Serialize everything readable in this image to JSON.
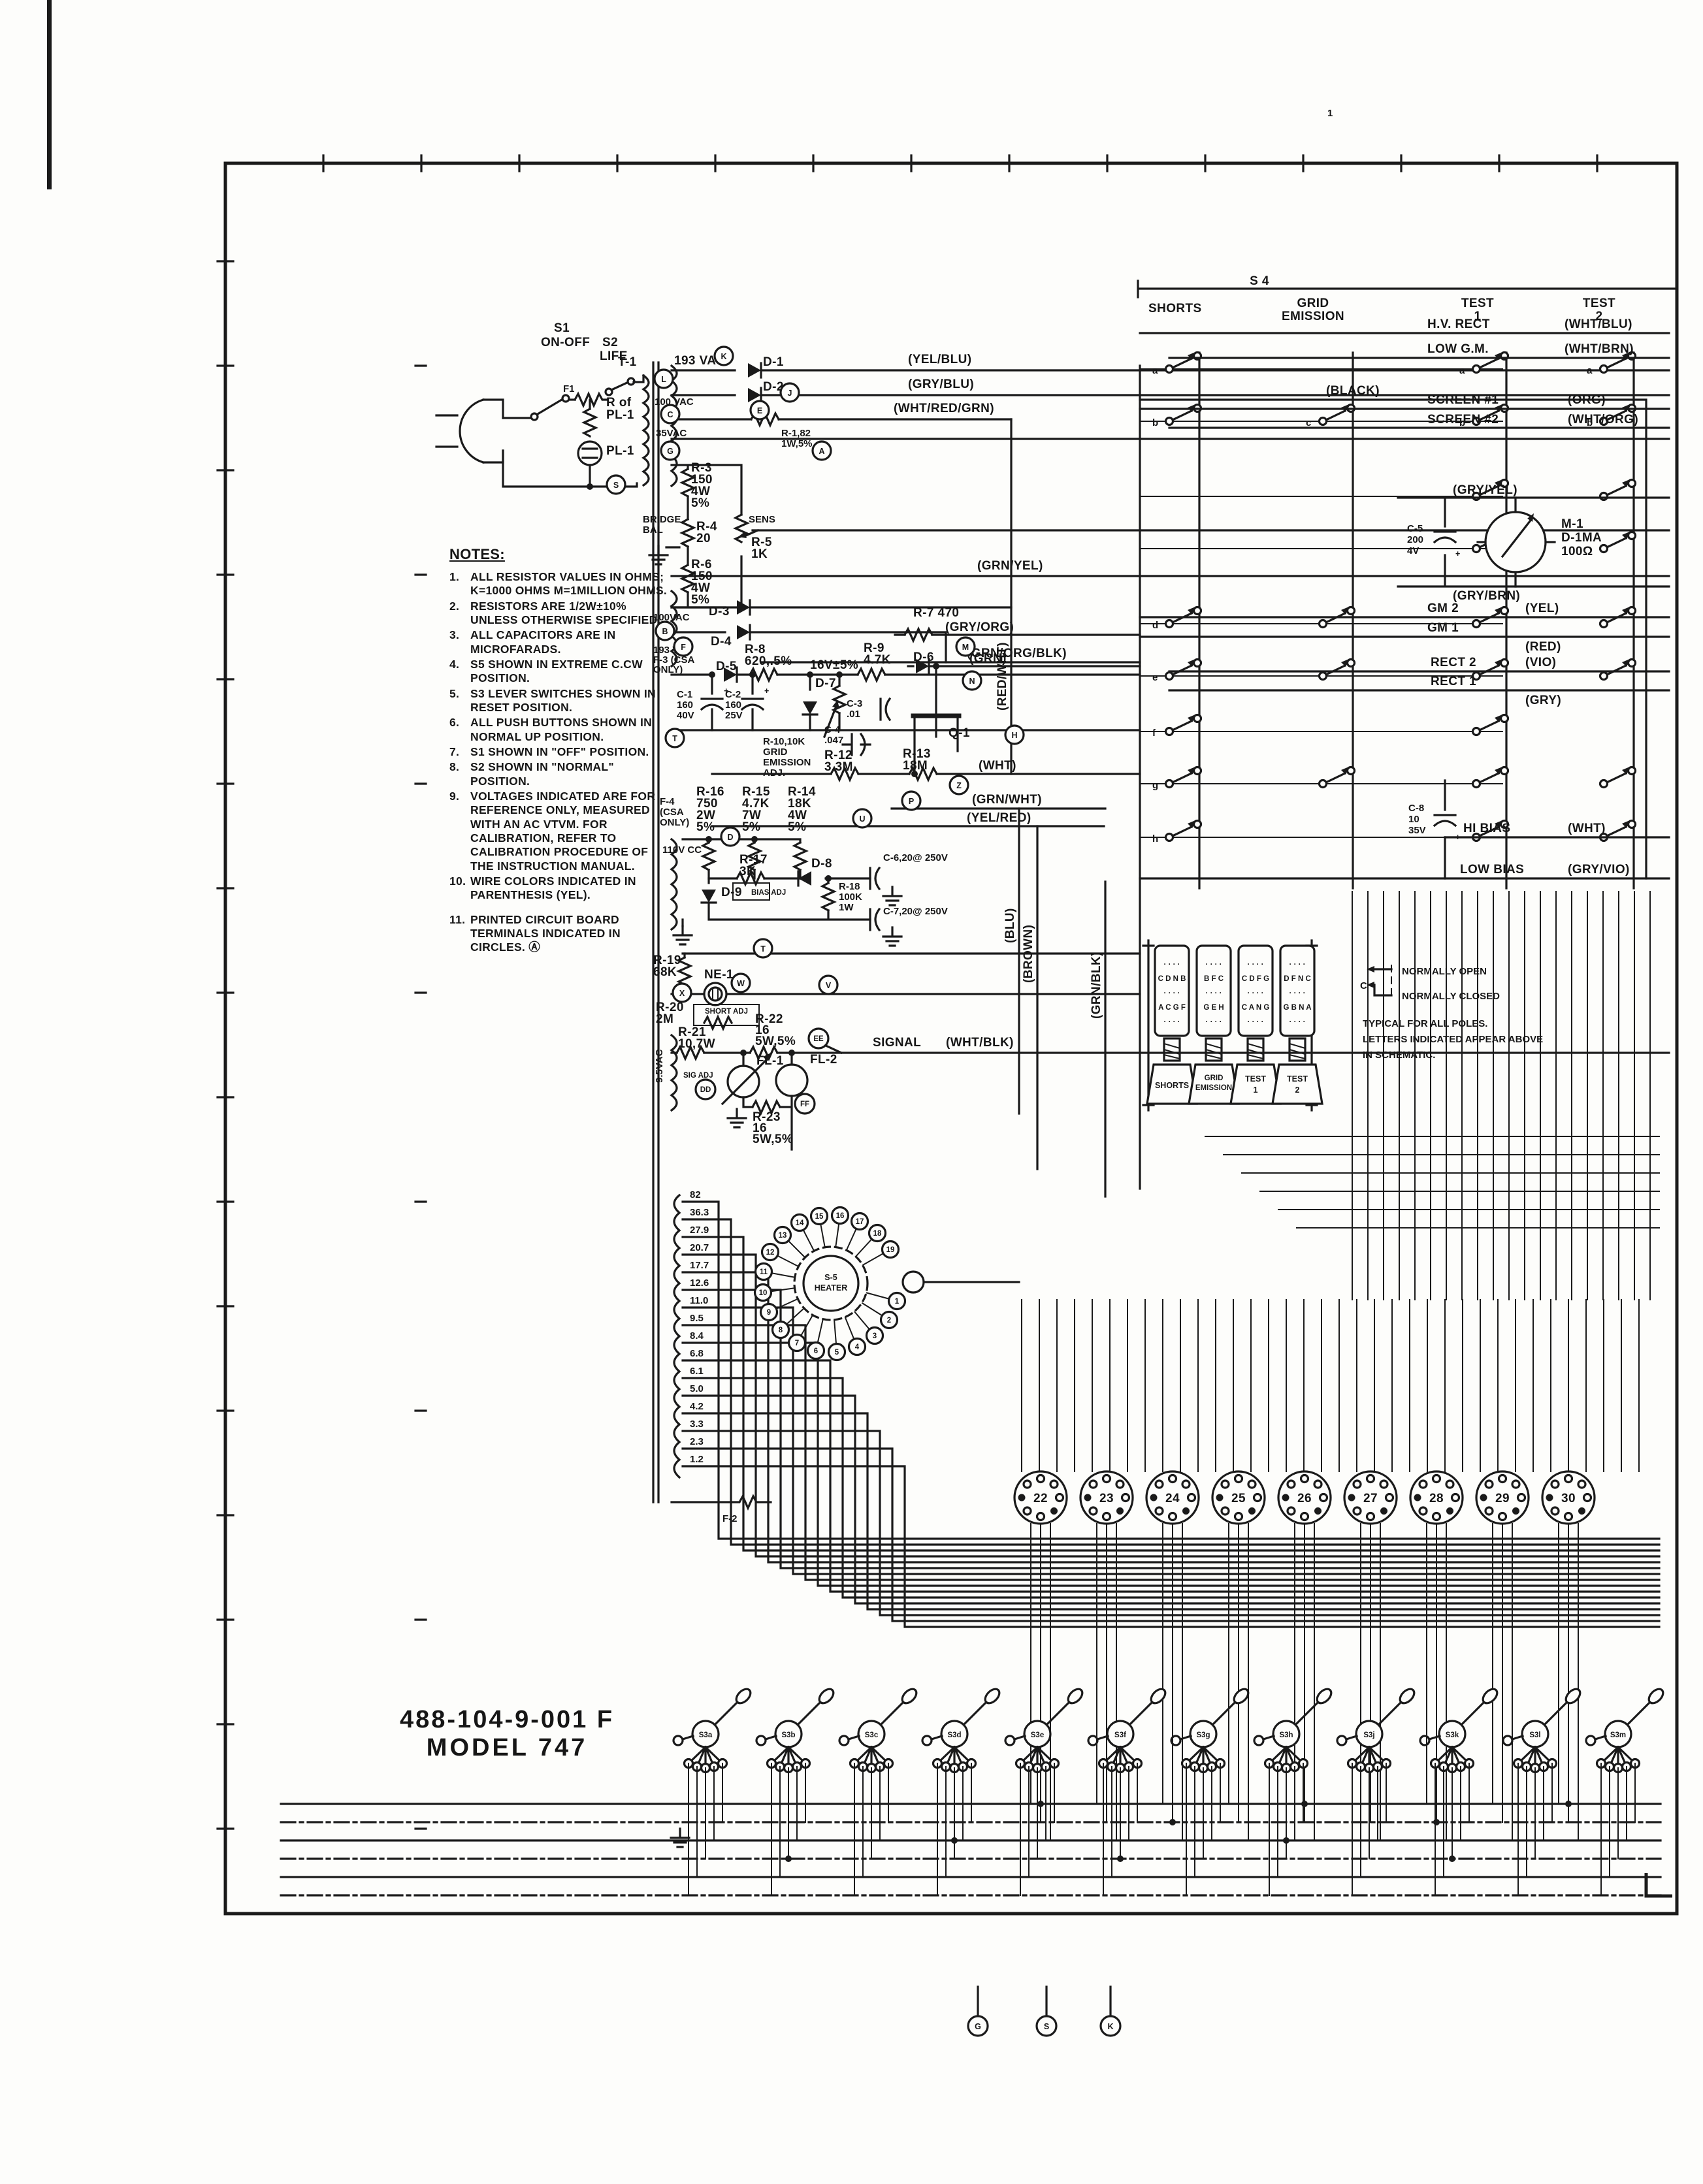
{
  "sheet": {
    "part_number": "488-104-9-001 F",
    "model": "MODEL 747",
    "page_mark": "1",
    "s4_label": "S 4"
  },
  "notes": {
    "title": "NOTES:",
    "items": [
      {
        "n": "1.",
        "t": "ALL RESISTOR VALUES IN OHMS; K=1000 OHMS M=1MILLION OHMS."
      },
      {
        "n": "2.",
        "t": "RESISTORS ARE 1/2W±10% UNLESS OTHERWISE SPECIFIED."
      },
      {
        "n": "3.",
        "t": "ALL CAPACITORS ARE IN MICROFARADS."
      },
      {
        "n": "4.",
        "t": "S5 SHOWN IN EXTREME C.CW POSITION."
      },
      {
        "n": "5.",
        "t": "S3 LEVER SWITCHES SHOWN IN RESET POSITION."
      },
      {
        "n": "6.",
        "t": "ALL PUSH BUTTONS SHOWN IN NORMAL UP POSITION."
      },
      {
        "n": "7.",
        "t": "S1 SHOWN IN \"OFF\" POSITION."
      },
      {
        "n": "8.",
        "t": "S2 SHOWN IN \"NORMAL\" POSITION."
      },
      {
        "n": "9.",
        "t": "VOLTAGES INDICATED ARE FOR REFERENCE ONLY, MEASURED WITH AN AC VTVM. FOR CALIBRATION, REFER TO CALIBRATION PROCEDURE OF THE INSTRUCTION MANUAL."
      },
      {
        "n": "10.",
        "t": "WIRE COLORS INDICATED IN PARENTHESIS (YEL)."
      },
      {
        "n": "11.",
        "t": "PRINTED CIRCUIT BOARD TERMINALS INDICATED IN CIRCLES. Ⓐ"
      }
    ]
  },
  "lbl": {
    "s1": "S1",
    "s1b": "ON-OFF",
    "s2": "S2",
    "s2b": "LIFE",
    "f1": "F1",
    "rofpl": [
      "R of",
      "PL-1"
    ],
    "pl1": "PL-1",
    "t1": "T-1",
    "v193": "193 VAC",
    "v100": "100 VAC",
    "v100b": "100VAC",
    "v35": "35VAC",
    "v95": "9.5VAC",
    "v110": "110V CC",
    "f2": "F-2",
    "f3": [
      "193 VAC",
      "F-3 (CSA",
      "ONLY)"
    ],
    "f4": [
      "F-4",
      "(CSA",
      "ONLY)"
    ],
    "d1": "D-1",
    "d2": "D-2",
    "d3": "D-3",
    "d4": "D-4",
    "d5": "D-5",
    "d6": "D-6",
    "d7": "D-7",
    "d8": "D-8",
    "d9": "D-9",
    "r1": [
      "R-1,82",
      "1W,5%"
    ],
    "r3": [
      "R-3",
      "150",
      "4W",
      "5%"
    ],
    "bridge": [
      "BRIDGE",
      "BAL"
    ],
    "r4": [
      "R-4",
      "20"
    ],
    "sens": "SENS",
    "r5": [
      "R-5",
      "1K"
    ],
    "r6": [
      "R-6",
      "150",
      "4W",
      "5%"
    ],
    "r8": [
      "R-8",
      "620,.5%"
    ],
    "v16": "16V±5%",
    "r9": [
      "R-9",
      "4.7K"
    ],
    "c1": [
      "C-1",
      "160",
      "40V"
    ],
    "c2": [
      "C-2",
      "160",
      "25V"
    ],
    "r10": [
      "R-10,10K",
      "GRID",
      "EMISSION",
      "ADJ."
    ],
    "r7": [
      "R-7",
      "470"
    ],
    "r11": [
      "R-11",
      "3.3K"
    ],
    "c3": [
      "C-3",
      ".01"
    ],
    "c4": [
      "C-4",
      ".047"
    ],
    "r12": [
      "R-12",
      "3.3M"
    ],
    "r13": [
      "R-13",
      "18M"
    ],
    "q1": "Q-1",
    "r14": [
      "R-14",
      "18K",
      "4W",
      "5%"
    ],
    "r15": [
      "R-15",
      "4.7K",
      "7W",
      "5%"
    ],
    "r16": [
      "R-16",
      "750",
      "2W",
      "5%"
    ],
    "r17": [
      "R-17",
      "3K"
    ],
    "bias": "BIAS ADJ",
    "r18": [
      "R-18",
      "100K",
      "1W"
    ],
    "c6": "C-6,20@ 250V",
    "c7": "C-7,20@ 250V",
    "r19": [
      "R-19",
      "68K"
    ],
    "ne1": "NE-1",
    "r20": [
      "R-20",
      "2M"
    ],
    "shortadj": "SHORT ADJ",
    "r21": [
      "R-21",
      "10,7W"
    ],
    "sigadj": "SIG ADJ",
    "r22": [
      "R-22",
      "16",
      "5W,5%"
    ],
    "fl1": "FL-1",
    "fl2": "FL-2",
    "r23": [
      "R-23",
      "16",
      "5W,5%"
    ],
    "signal": "SIGNAL",
    "plus": "+"
  },
  "wires": {
    "yel_blu": "(YEL/BLU)",
    "gry_blu": "(GRY/BLU)",
    "wrg": "(WHT/RED/GRN)",
    "grn_yel": "(GRN/YEL)",
    "gob": "(GRN/ORG/BLK)",
    "gry_org": "(GRY/ORG)",
    "grn": "(GRN)",
    "wht": "(WHT)",
    "grn_wht": "(GRN/WHT)",
    "yel_red": "(YEL/RED)",
    "red_wht": "(RED/WHT)",
    "blu": "(BLU)",
    "brown": "(BROWN)",
    "grn_blk": "(GRN/BLK)",
    "wht_blk": "(WHT/BLK)"
  },
  "s4cols": [
    [
      "SHORTS"
    ],
    [
      "GRID",
      "EMISSION"
    ],
    [
      "TEST",
      "1"
    ],
    [
      "TEST",
      "2"
    ]
  ],
  "rows": [
    {
      "name": "H.V. RECT",
      "color": "(WHT/BLU)"
    },
    {
      "name": "LOW G.M.",
      "color": "(WHT/BRN)"
    },
    {
      "name": "",
      "color": "(BLACK)"
    },
    {
      "name": "SCREEN #1",
      "color": "(ORG)"
    },
    {
      "name": "SCREEN #2",
      "color": "(WHT/ORG)"
    },
    {
      "name": "GM 2",
      "color": "(YEL)"
    },
    {
      "name": "GM 1",
      "color": "(RED)"
    },
    {
      "name": "RECT 2",
      "color": "(VIO)"
    },
    {
      "name": "RECT 1",
      "color": "(GRY)"
    },
    {
      "name": "HI BIAS",
      "color": "(WHT)"
    },
    {
      "name": "LOW BIAS",
      "color": "(GRY/VIO)"
    }
  ],
  "meter": {
    "c5": [
      "C-5",
      "200",
      "4V"
    ],
    "m1": [
      "M-1",
      "D-1MA",
      "100Ω"
    ],
    "top": "(GRY/YEL)",
    "bot": "(GRY/BRN)",
    "c8": [
      "C-8",
      "10",
      "35V"
    ]
  },
  "legend": {
    "open": "NORMALLY OPEN",
    "closed": "NORMALLY CLOSED",
    "c": "C",
    "note": [
      "TYPICAL FOR ALL POLES.",
      "LETTERS INDICATED APPEAR ABOVE",
      "IN SCHEMATIC."
    ]
  },
  "buttons": {
    "dots": "· · · ·",
    "rows": [
      [
        "C D N B",
        "A C G F"
      ],
      [
        "B F C",
        "G E H"
      ],
      [
        "C D F G",
        "C A N G"
      ],
      [
        "D F N C",
        "G B N A"
      ]
    ]
  },
  "heater": {
    "name": [
      "S-5",
      "HEATER"
    ],
    "taps": [
      "82",
      "36.3",
      "27.9",
      "20.7",
      "17.7",
      "12.6",
      "11.0",
      "9.5",
      "8.4",
      "6.8",
      "6.1",
      "5.0",
      "4.2",
      "3.3",
      "2.3",
      "1.2"
    ],
    "contacts": [
      "1",
      "2",
      "3",
      "4",
      "5",
      "6",
      "7",
      "8",
      "9",
      "10",
      "11",
      "12",
      "13",
      "14",
      "15",
      "16",
      "17",
      "18",
      "19"
    ]
  },
  "sockets": [
    "22",
    "23",
    "24",
    "25",
    "26",
    "27",
    "28",
    "29",
    "30"
  ],
  "levers": [
    "S3a",
    "S3b",
    "S3c",
    "S3d",
    "S3e",
    "S3f",
    "S3g",
    "S3h",
    "S3j",
    "S3k",
    "S3l",
    "S3m"
  ],
  "terminals": [
    "K",
    "L",
    "C",
    "E",
    "G",
    "S",
    "J",
    "A",
    "B",
    "F",
    "M",
    "N",
    "H",
    "Z",
    "P",
    "U",
    "D",
    "T",
    "T",
    "X",
    "W",
    "V",
    "DD",
    "EE",
    "FF",
    "G",
    "S",
    "K"
  ],
  "poles": [
    "a",
    "b",
    "c",
    "d",
    "e",
    "f",
    "g",
    "h"
  ]
}
